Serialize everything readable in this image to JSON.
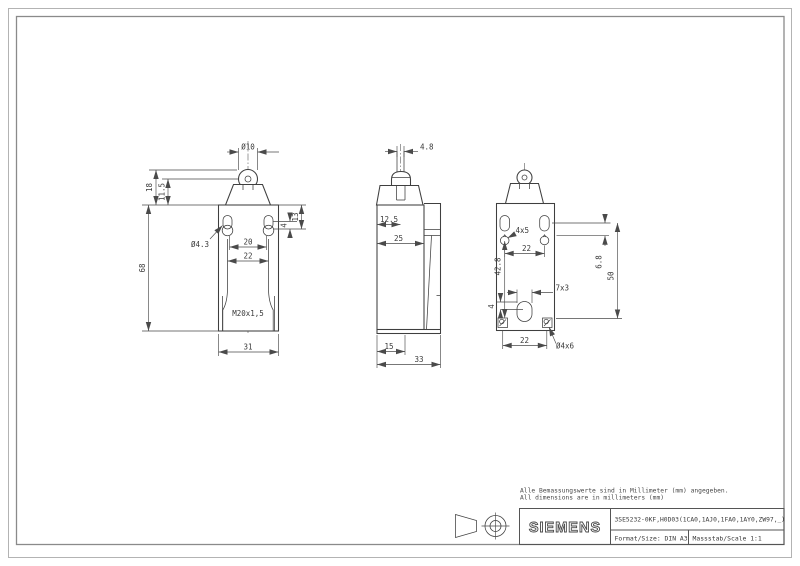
{
  "sheet": {
    "background": "#ffffff",
    "border_color": "#8a8a8a",
    "line_color": "#3f3f3f",
    "dim_color": "#4a4a4a"
  },
  "notes": {
    "line1": "Alle Bemassungswerte sind in Millimeter (mm) angegeben.",
    "line2": "All dimensions are in millimeters (mm)"
  },
  "title_block": {
    "brand": "SIEMENS",
    "part_number": "3SE5232-0KF,H0D03(1CA0,1AJ0,1FA0,1AY0,ZW97,_)",
    "format_label": "Format/Size: DIN A3",
    "scale_label": "Massstab/Scale 1:1"
  },
  "views": {
    "front": {
      "dia10": "Ø10",
      "h18": "18",
      "h11_5": "11.5",
      "h13": "13",
      "h4": "4",
      "dia4_3": "Ø4.3",
      "w20": "20",
      "w22": "22",
      "h68": "68",
      "thread": "M20x1,5",
      "w31": "31"
    },
    "side": {
      "w4_8": "4.8",
      "w12_5": "12.5",
      "w25": "25",
      "w15": "15",
      "w33": "33"
    },
    "rear": {
      "slot": "4x5",
      "w22_top": "22",
      "h42_8": "42.8",
      "h6_8": "6.8",
      "h50": "50",
      "slot7x3": "7x3",
      "h4": "4",
      "w22_bottom": "22",
      "hole": "Ø4x6"
    }
  }
}
